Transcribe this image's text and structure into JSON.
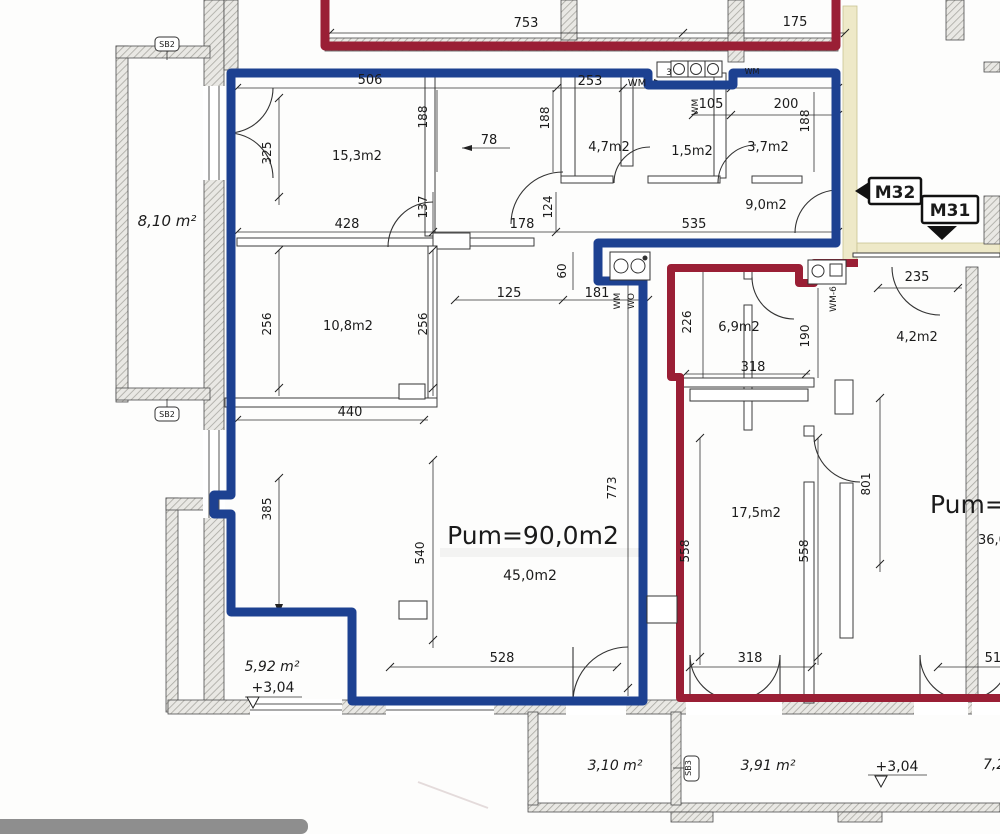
{
  "title": "Apartment floor plan scan (M31 / M32)",
  "colors": {
    "apartment_m32_outline": "#1d4191",
    "apartment_m31_outline": "#9a1f35",
    "corridor_fill": "#eee9c8",
    "corridor_border": "#c9c293",
    "wall_stroke": "#4d4d4d",
    "ink": "#1b1b1b",
    "scanbar": "#8e8e8e"
  },
  "apartments": [
    {
      "id": "M32",
      "area_label": "Pum=90,0m2",
      "outline_color_key": "apartment_m32_outline"
    },
    {
      "id": "M31",
      "area_label": "Pum=6",
      "outline_color_key": "apartment_m31_outline"
    }
  ],
  "labels": [
    {
      "n": "dim-753",
      "t": "753",
      "x": 526,
      "y": 27,
      "s": 13
    },
    {
      "n": "dim-175",
      "t": "175",
      "x": 795,
      "y": 26,
      "s": 13
    },
    {
      "n": "dim-506",
      "t": "506",
      "x": 370,
      "y": 84,
      "s": 13
    },
    {
      "n": "dim-253",
      "t": "253",
      "x": 590,
      "y": 85,
      "s": 13
    },
    {
      "n": "label-wm-arrow",
      "t": "WM",
      "x": 637,
      "y": 86,
      "s": 10
    },
    {
      "n": "dim-105",
      "t": "105",
      "x": 711,
      "y": 108,
      "s": 13
    },
    {
      "n": "dim-200",
      "t": "200",
      "x": 786,
      "y": 108,
      "s": 13
    },
    {
      "n": "dim-188-a",
      "t": "188",
      "x": 427,
      "y": 117,
      "s": 12,
      "r": -90
    },
    {
      "n": "dim-188-b",
      "t": "188",
      "x": 549,
      "y": 118,
      "s": 12,
      "r": -90
    },
    {
      "n": "dim-188-c",
      "t": "188",
      "x": 809,
      "y": 121,
      "s": 12,
      "r": -90
    },
    {
      "n": "dim-78",
      "t": "78",
      "x": 489,
      "y": 144,
      "s": 13
    },
    {
      "n": "dim-325",
      "t": "325",
      "x": 271,
      "y": 153,
      "s": 12,
      "r": -90
    },
    {
      "n": "room-15-3",
      "t": "15,3m2",
      "x": 357,
      "y": 160,
      "s": 13
    },
    {
      "n": "room-4-7",
      "t": "4,7m2",
      "x": 609,
      "y": 151,
      "s": 13
    },
    {
      "n": "room-1-5",
      "t": "1,5m2",
      "x": 692,
      "y": 155,
      "s": 13
    },
    {
      "n": "room-3-7",
      "t": "3,7m2",
      "x": 768,
      "y": 151,
      "s": 13
    },
    {
      "n": "room-9-0",
      "t": "9,0m2",
      "x": 766,
      "y": 209,
      "s": 13
    },
    {
      "n": "room-8-10",
      "t": "8,10 m²",
      "x": 167,
      "y": 226,
      "s": 15,
      "i": 1
    },
    {
      "n": "dim-428",
      "t": "428",
      "x": 347,
      "y": 228,
      "s": 13
    },
    {
      "n": "dim-137",
      "t": "137",
      "x": 427,
      "y": 207,
      "s": 12,
      "r": -90
    },
    {
      "n": "dim-178",
      "t": "178",
      "x": 522,
      "y": 228,
      "s": 13
    },
    {
      "n": "dim-124",
      "t": "124",
      "x": 552,
      "y": 207,
      "s": 12,
      "r": -90
    },
    {
      "n": "dim-535",
      "t": "535",
      "x": 694,
      "y": 228,
      "s": 13
    },
    {
      "n": "dim-60",
      "t": "60",
      "x": 566,
      "y": 271,
      "s": 12,
      "r": -90
    },
    {
      "n": "dim-125",
      "t": "125",
      "x": 509,
      "y": 297,
      "s": 13
    },
    {
      "n": "dim-181",
      "t": "181",
      "x": 597,
      "y": 297,
      "s": 13
    },
    {
      "n": "label-wm-vert",
      "t": "WM",
      "x": 698,
      "y": 107,
      "s": 9,
      "r": -90
    },
    {
      "n": "label-wm-kitchen",
      "t": "WM",
      "x": 620,
      "y": 301,
      "s": 9,
      "r": -90
    },
    {
      "n": "label-wo-kitchen",
      "t": "WO",
      "x": 634,
      "y": 301,
      "s": 9,
      "r": -90
    },
    {
      "n": "label-wm6",
      "t": "WM-6",
      "x": 836,
      "y": 299,
      "s": 9,
      "r": -90
    },
    {
      "n": "label-wm-niche",
      "t": "WM",
      "x": 752,
      "y": 74,
      "s": 8
    },
    {
      "n": "label-niche-3",
      "t": "3",
      "x": 669,
      "y": 75,
      "s": 9
    },
    {
      "n": "dim-226",
      "t": "226",
      "x": 691,
      "y": 322,
      "s": 12,
      "r": -90
    },
    {
      "n": "dim-190",
      "t": "190",
      "x": 809,
      "y": 336,
      "s": 12,
      "r": -90
    },
    {
      "n": "dim-235",
      "t": "235",
      "x": 917,
      "y": 281,
      "s": 13
    },
    {
      "n": "room-6-9",
      "t": "6,9m2",
      "x": 739,
      "y": 331,
      "s": 13
    },
    {
      "n": "room-4-2",
      "t": "4,2m2",
      "x": 917,
      "y": 341,
      "s": 13
    },
    {
      "n": "dim-318-a",
      "t": "318",
      "x": 753,
      "y": 371,
      "s": 13
    },
    {
      "n": "room-10-8",
      "t": "10,8m2",
      "x": 348,
      "y": 330,
      "s": 13
    },
    {
      "n": "dim-256-a",
      "t": "256",
      "x": 271,
      "y": 324,
      "s": 12,
      "r": -90
    },
    {
      "n": "dim-256-b",
      "t": "256",
      "x": 427,
      "y": 324,
      "s": 12,
      "r": -90
    },
    {
      "n": "dim-440",
      "t": "440",
      "x": 350,
      "y": 416,
      "s": 13
    },
    {
      "n": "dim-385",
      "t": "385",
      "x": 271,
      "y": 509,
      "s": 12,
      "r": -90
    },
    {
      "n": "dim-540",
      "t": "540",
      "x": 424,
      "y": 553,
      "s": 12,
      "r": -90
    },
    {
      "n": "dim-773",
      "t": "773",
      "x": 616,
      "y": 488,
      "s": 12,
      "r": -90
    },
    {
      "n": "dim-558-a",
      "t": "558",
      "x": 689,
      "y": 551,
      "s": 12,
      "r": -90
    },
    {
      "n": "dim-558-b",
      "t": "558",
      "x": 808,
      "y": 551,
      "s": 12,
      "r": -90
    },
    {
      "n": "dim-801",
      "t": "801",
      "x": 870,
      "y": 484,
      "s": 12,
      "r": -90
    },
    {
      "n": "room-pum90",
      "t": "Pum=90,0m2",
      "x": 533,
      "y": 544,
      "s": 25
    },
    {
      "n": "room-45-0",
      "t": "45,0m2",
      "x": 530,
      "y": 580,
      "s": 14
    },
    {
      "n": "room-17-5",
      "t": "17,5m2",
      "x": 756,
      "y": 517,
      "s": 13
    },
    {
      "n": "room-pum6",
      "t": "Pum=6",
      "x": 930,
      "y": 513,
      "s": 25,
      "a": "start"
    },
    {
      "n": "room-36-0",
      "t": "36,0",
      "x": 978,
      "y": 544,
      "s": 13,
      "a": "start"
    },
    {
      "n": "room-5-92",
      "t": "5,92 m²",
      "x": 272,
      "y": 671,
      "s": 14,
      "i": 1
    },
    {
      "n": "level-mark-1",
      "t": "+3,04",
      "x": 273,
      "y": 692,
      "s": 14
    },
    {
      "n": "dim-528",
      "t": "528",
      "x": 502,
      "y": 662,
      "s": 13
    },
    {
      "n": "dim-318-b",
      "t": "318",
      "x": 750,
      "y": 662,
      "s": 13
    },
    {
      "n": "dim-510",
      "t": "510",
      "x": 997,
      "y": 662,
      "s": 13
    },
    {
      "n": "room-3-10",
      "t": "3,10 m²",
      "x": 615,
      "y": 770,
      "s": 14,
      "i": 1
    },
    {
      "n": "room-3-91",
      "t": "3,91 m²",
      "x": 768,
      "y": 770,
      "s": 14,
      "i": 1
    },
    {
      "n": "level-mark-2",
      "t": "+3,04",
      "x": 897,
      "y": 771,
      "s": 14
    },
    {
      "n": "room-7-2",
      "t": "7,2",
      "x": 983,
      "y": 769,
      "s": 14,
      "i": 1,
      "a": "start"
    },
    {
      "n": "tag-m32-label",
      "t": "M32",
      "x": 895,
      "y": 198,
      "s": 17,
      "w": 1
    },
    {
      "n": "tag-m31-label",
      "t": "M31",
      "x": 950,
      "y": 216,
      "s": 17,
      "w": 1
    },
    {
      "n": "tag-sb2-top",
      "t": "SB2",
      "x": 167,
      "y": 47,
      "s": 8
    },
    {
      "n": "tag-sb2-bottom",
      "t": "SB2",
      "x": 167,
      "y": 417,
      "s": 8
    },
    {
      "n": "tag-sb3",
      "t": "SB3",
      "x": 691,
      "y": 768,
      "s": 8,
      "r": -90
    }
  ]
}
